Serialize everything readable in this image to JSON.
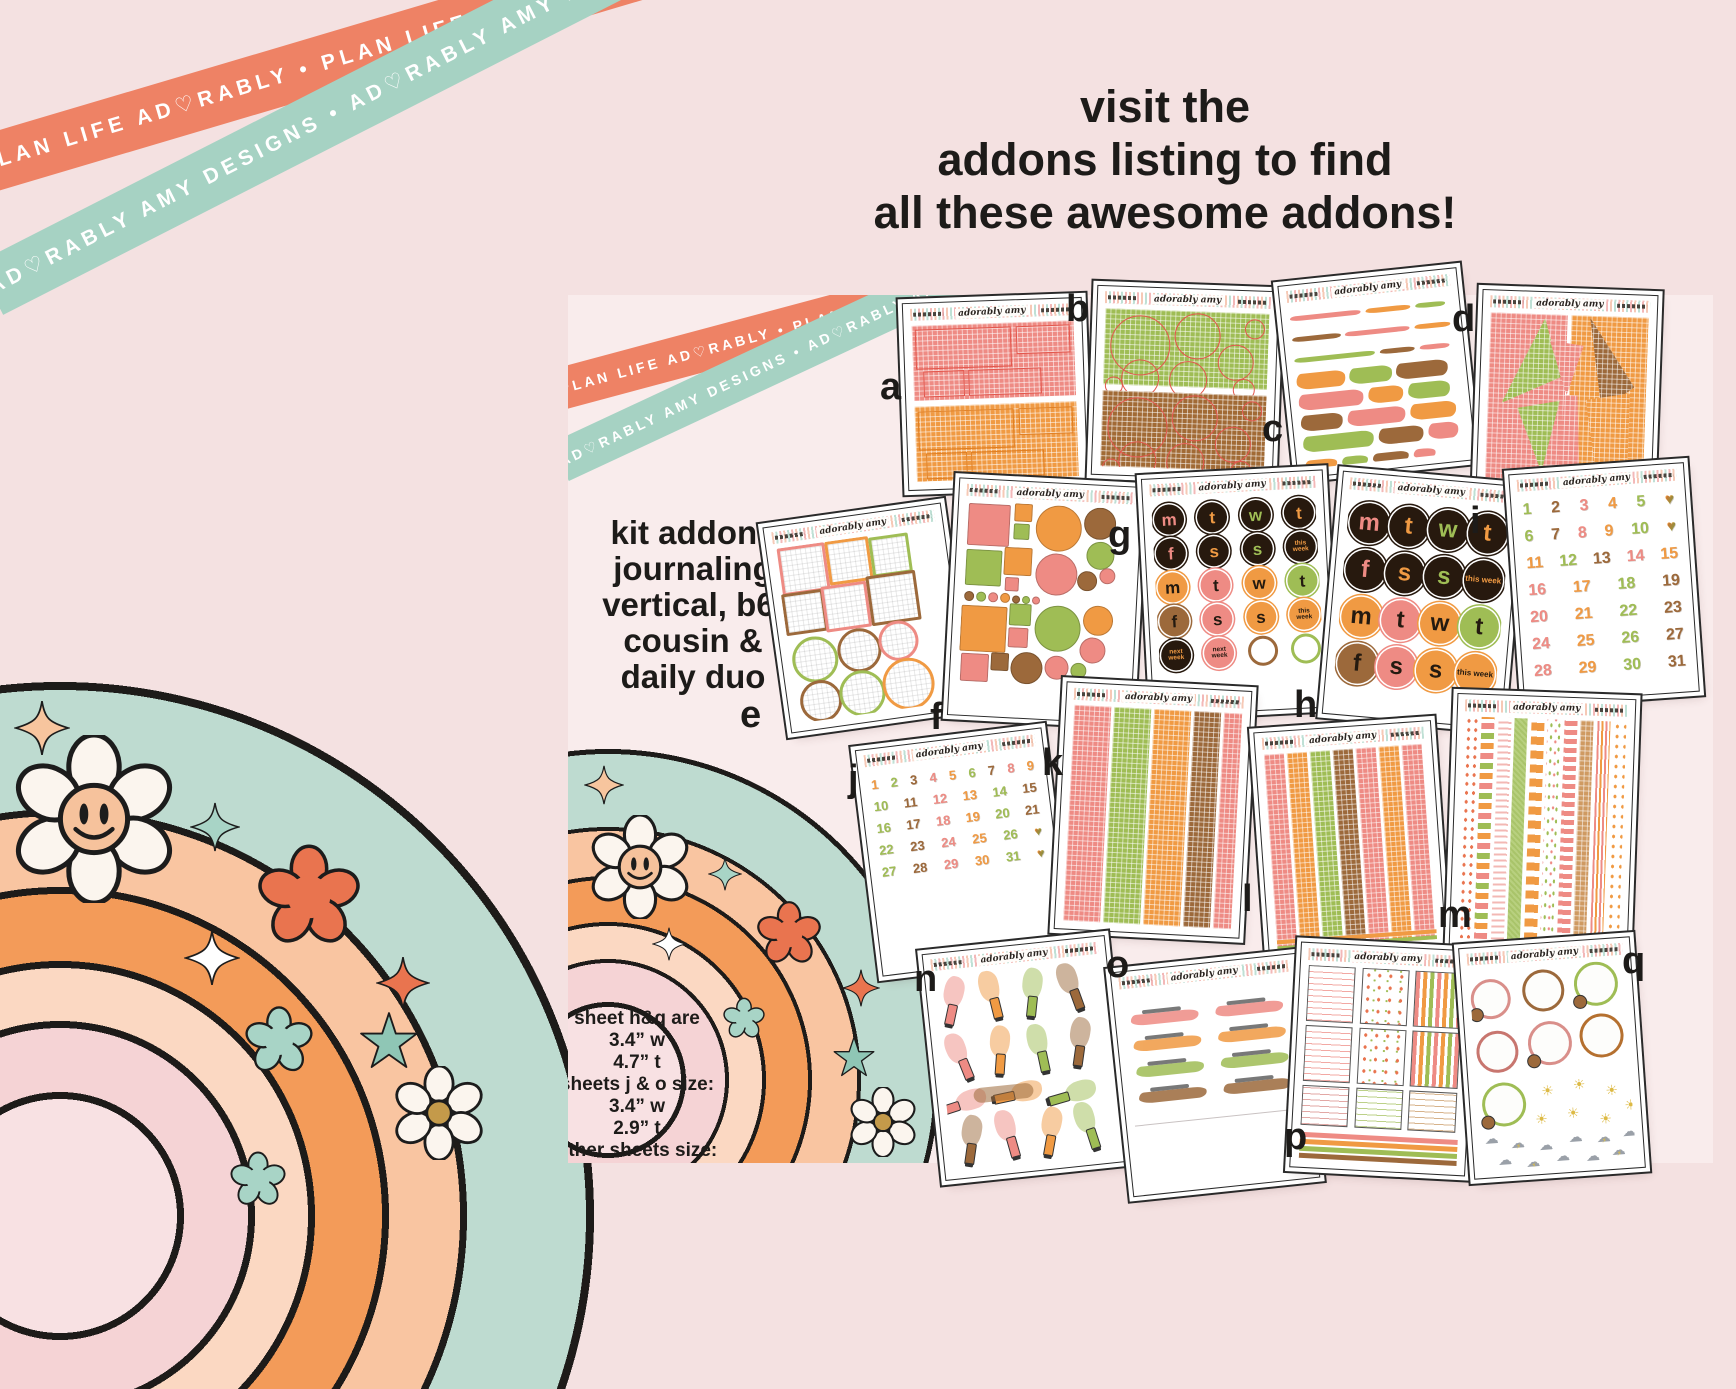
{
  "headline": {
    "line1": "visit the",
    "line2": "addons listing to find",
    "line3": "all these awesome addons!"
  },
  "tapes": {
    "coral": "PLAN LIFE AD♡RABLY • PLAN LIFE AD♡RABLY • PLAN LIFE AD♡RABLY • PLAN LIFE AD♡RABLY •",
    "mint": "AD♡RABLY AMY DESIGNS • AD♡RABLY AMY DESIGNS • AD♡RABLY AMY DESIGNS • AD♡RABLY AMY DESIGNS •"
  },
  "brand": {
    "script": "adorably amy"
  },
  "panel": {
    "kit_lines": [
      "kit addons",
      "journaling",
      "vertical, b6,",
      "cousin &",
      "daily duo"
    ],
    "size_lines": [
      "sheet h&q are",
      "3.4” w",
      "4.7” t",
      "sheets j & o size:",
      "3.4” w",
      "2.9” t",
      "other sheets size:",
      "4.88” w",
      "7.00” t"
    ]
  },
  "weekdays": {
    "letters": [
      "m",
      "t",
      "w",
      "t",
      "f",
      "s",
      "s"
    ],
    "this_week": "this week",
    "next_week": "next week"
  },
  "dates": {
    "i": [
      [
        "1",
        "2",
        "3",
        "4",
        "5",
        "♥"
      ],
      [
        "6",
        "7",
        "8",
        "9",
        "10",
        "♥"
      ],
      [
        "11",
        "12",
        "13",
        "14",
        "15"
      ],
      [
        "16",
        "17",
        "18",
        "19"
      ],
      [
        "20",
        "21",
        "22",
        "23"
      ],
      [
        "24",
        "25",
        "26",
        "27"
      ],
      [
        "28",
        "29",
        "30",
        "31"
      ]
    ],
    "j": [
      [
        "1",
        "2",
        "3",
        "4",
        "5",
        "6",
        "7",
        "8",
        "9"
      ],
      [
        "10",
        "11",
        "12",
        "13",
        "14",
        "15"
      ],
      [
        "16",
        "17",
        "18",
        "19",
        "20",
        "21"
      ],
      [
        "22",
        "23",
        "24",
        "25",
        "26",
        "♥"
      ],
      [
        "27",
        "28",
        "29",
        "30",
        "31",
        "♥"
      ]
    ]
  },
  "sheets": [
    {
      "id": "a",
      "label": "a",
      "type": "grid2",
      "colors": [
        "#ee8b84",
        "#f09a43"
      ],
      "outlines": [
        "#e2574d",
        "#df7e22"
      ]
    },
    {
      "id": "b",
      "label": "b",
      "type": "gridcircles",
      "colors": [
        "#9fbd55",
        "#a16a35"
      ],
      "ring": "#e2574d"
    },
    {
      "id": "c",
      "label": "c",
      "type": "scribbles",
      "colors": [
        "#ee8b84",
        "#f09a43",
        "#9fbd55",
        "#9c693b"
      ]
    },
    {
      "id": "d",
      "label": "d",
      "type": "torn",
      "base": [
        "#ee8b84",
        "#f09a43"
      ],
      "wedges": [
        "#9fbd55",
        "#9c693b",
        "#ee8b84",
        "#f09a43"
      ]
    },
    {
      "id": "e",
      "label": "e",
      "type": "frames",
      "colors": [
        "#ee8b84",
        "#f09a43",
        "#9fbd55",
        "#9c693b"
      ]
    },
    {
      "id": "f",
      "label": "f",
      "type": "shapes",
      "colors": [
        "#ee8b84",
        "#9fbd55",
        "#f09a43",
        "#9c693b"
      ]
    },
    {
      "id": "g",
      "label": "g",
      "type": "weekdays",
      "size": "small"
    },
    {
      "id": "h",
      "label": "h",
      "type": "weekdays",
      "size": "large"
    },
    {
      "id": "i",
      "label": "i",
      "type": "dates",
      "rows_key": "i"
    },
    {
      "id": "j",
      "label": "j",
      "type": "dates",
      "rows_key": "j"
    },
    {
      "id": "k",
      "label": "k",
      "type": "stripes",
      "widths": [
        22,
        22,
        22,
        16,
        14
      ],
      "colors": [
        "#ee8b84",
        "#9fbd55",
        "#f09a43",
        "#9c693b",
        "#ee8b84"
      ]
    },
    {
      "id": "l",
      "label": "l",
      "type": "stripes",
      "widths": [
        12.5,
        12.5,
        12.5,
        12.5,
        12.5,
        12.5,
        12.5,
        12.5
      ],
      "colors": [
        "#ee8b84",
        "#f09a43",
        "#9fbd55",
        "#9c693b",
        "#ee8b84",
        "#f09a43",
        "#ee8b84",
        "#9fbd55"
      ],
      "footer": true
    },
    {
      "id": "m",
      "label": "m",
      "type": "washi"
    },
    {
      "id": "n",
      "label": "n",
      "type": "pens",
      "colors": [
        "#ee8b84",
        "#f09a43",
        "#9fbd55",
        "#9c693b"
      ]
    },
    {
      "id": "o",
      "label": "o",
      "type": "swashes",
      "colors": [
        "#ee8b84",
        "#f09a43",
        "#9fbd55",
        "#9c693b"
      ]
    },
    {
      "id": "p",
      "label": "p",
      "type": "kitboxes"
    },
    {
      "id": "q",
      "label": "q",
      "type": "weather",
      "rings": [
        "#d98f8a",
        "#9c693b",
        "#9fbd55",
        "#c8766f",
        "#d98f8a",
        "#b5702f",
        "#9fbd55"
      ]
    }
  ],
  "palette": {
    "bg": "#f4e1e1",
    "panel_bg": "#f9ecec",
    "ink": "#1d1b19",
    "coral_tape": "#ee8265",
    "mint_tape": "#a6d2c3",
    "pink": "#ee8b84",
    "orange": "#f09a43",
    "green": "#9fbd55",
    "brown": "#9c693b",
    "dark": "#27190e",
    "outline_coral": "#e2574d",
    "rb_mint": "#bedbd0",
    "rb_peach": "#f9c5a1",
    "rb_orange": "#f39b59",
    "rb_pale": "#fbd8c2",
    "rb_pink": "#f5d3d5",
    "rb_fill": "#f8e1e3",
    "flower_coral": "#e9744f",
    "teal": "#a8d4c6",
    "gold": "#c49a4a",
    "sun": "#ddba45",
    "cloud": "#9aa0a8"
  }
}
